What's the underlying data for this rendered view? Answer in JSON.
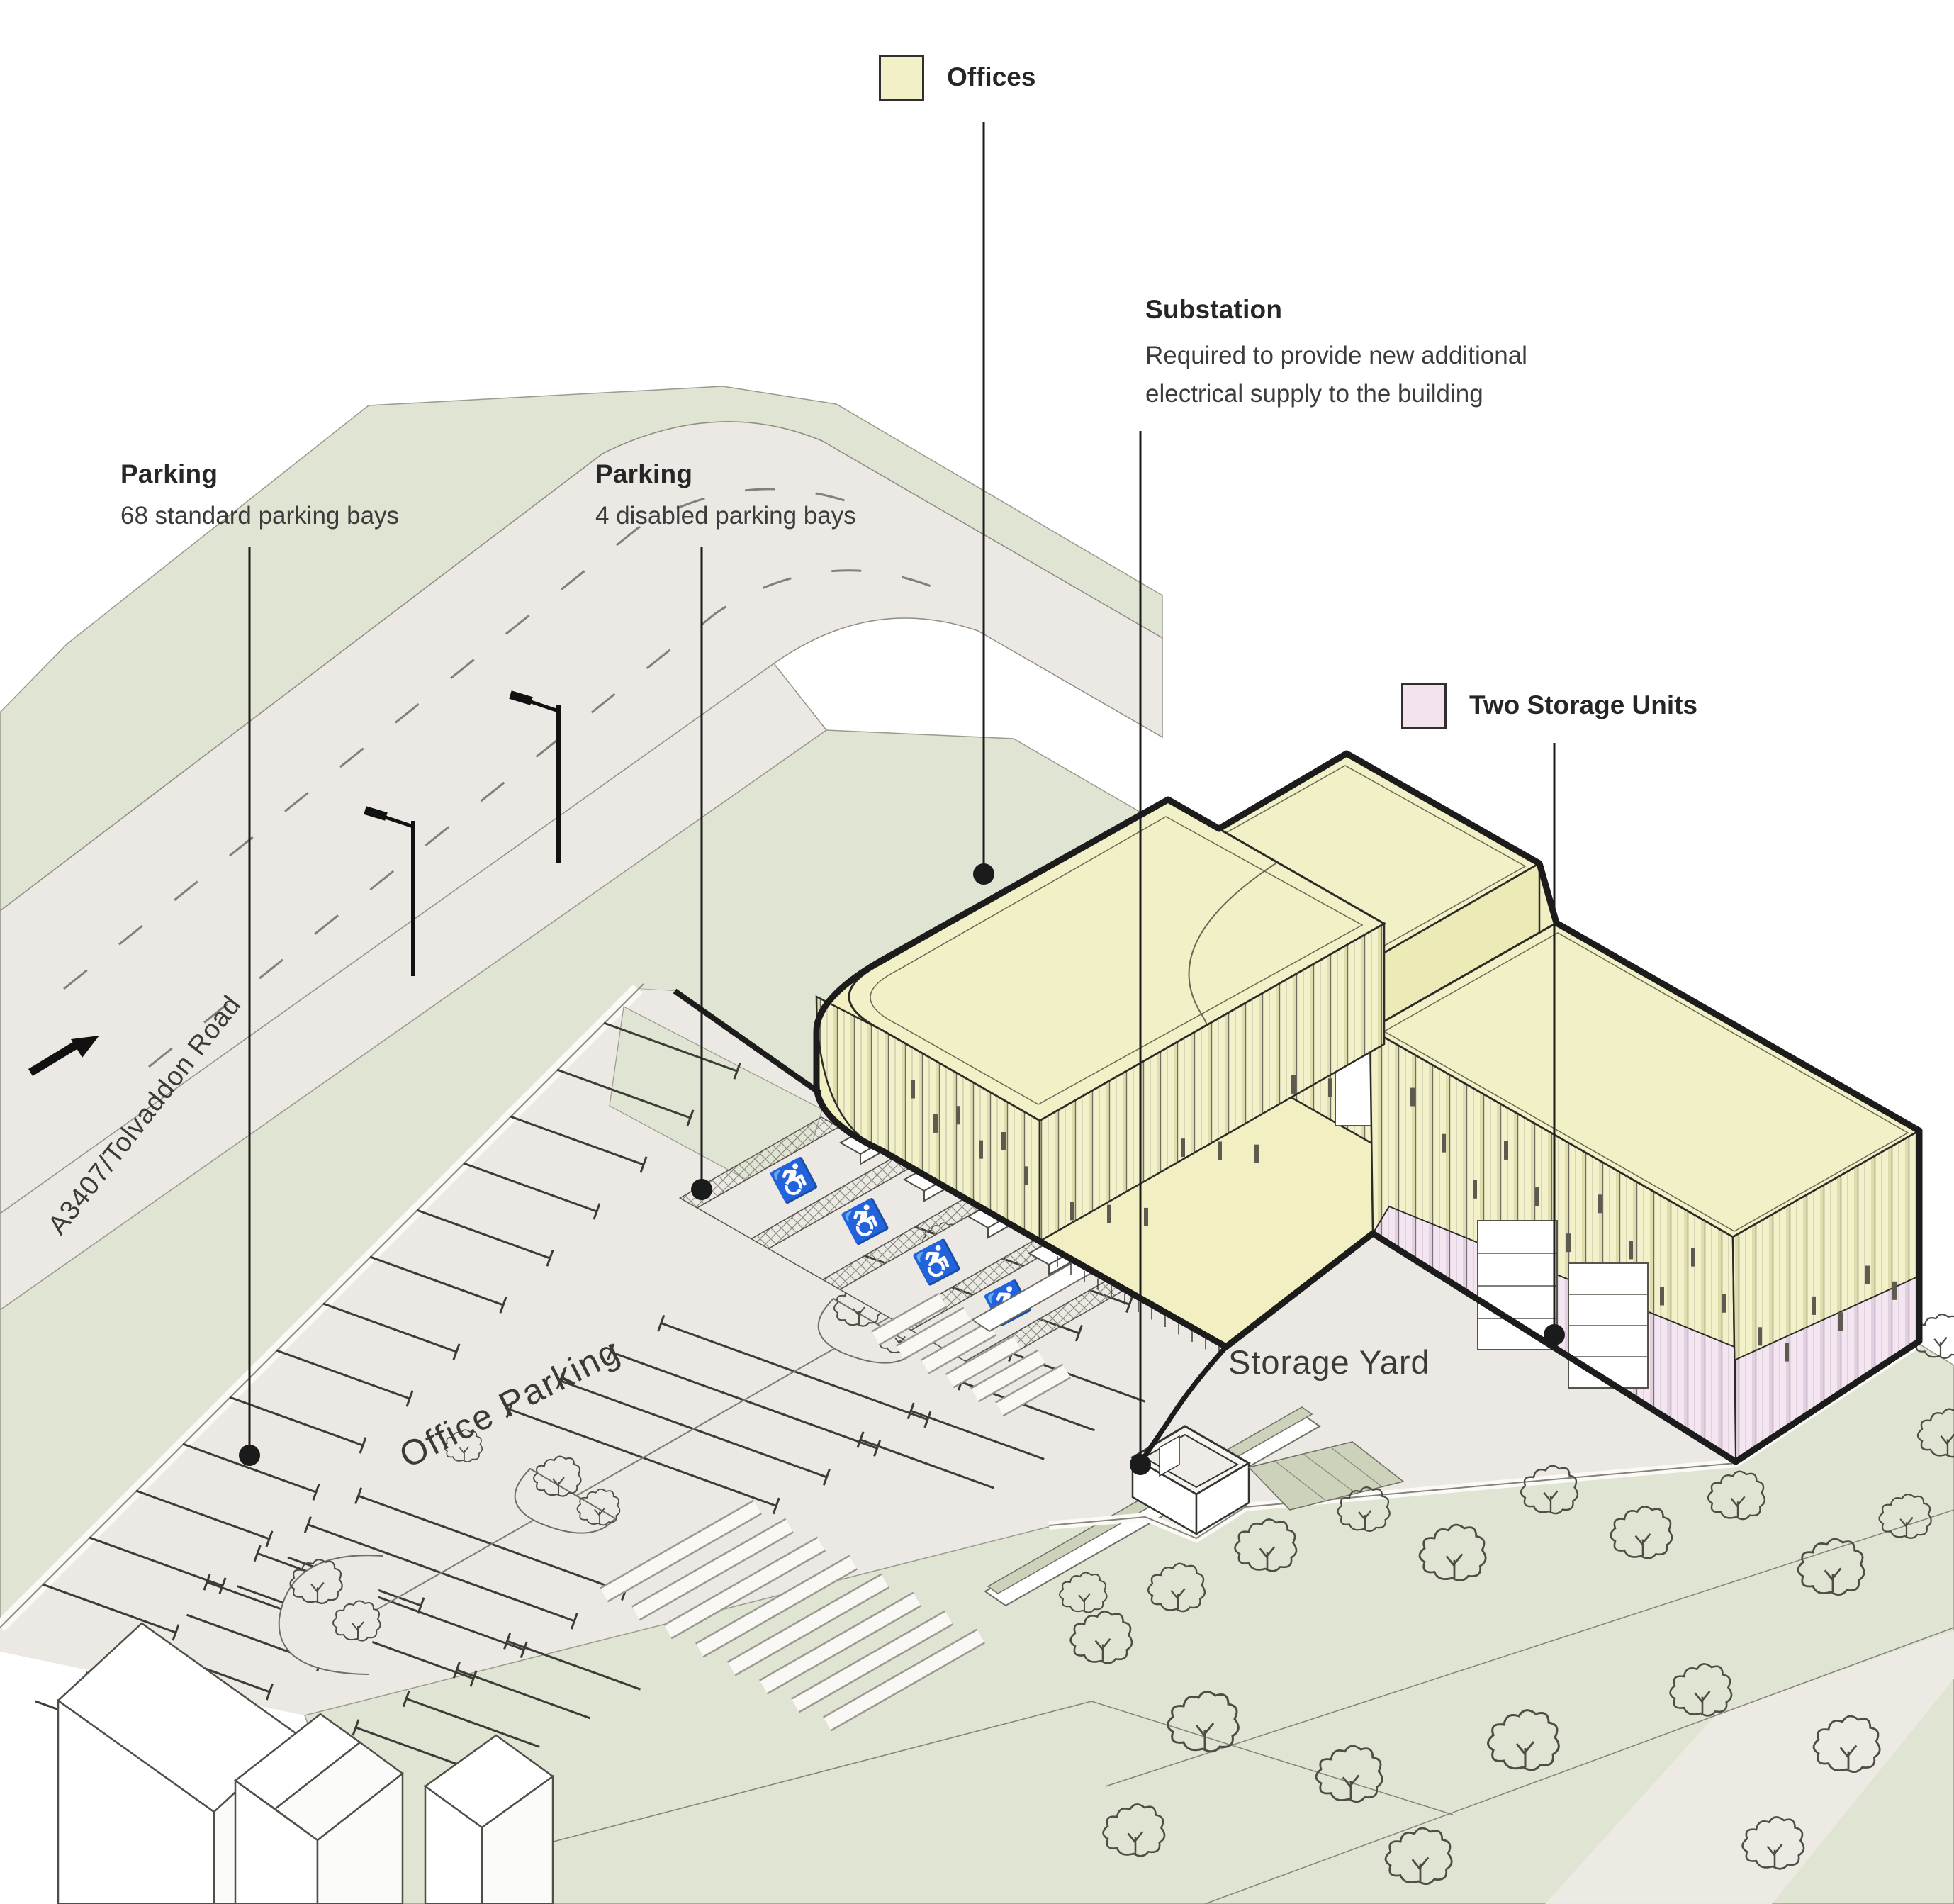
{
  "legend": {
    "offices": {
      "label": "Offices",
      "color": "#f2f0c6"
    },
    "two_storage_units": {
      "label": "Two Storage Units",
      "color": "#f2e3ee"
    }
  },
  "annotations": {
    "parking_standard": {
      "title": "Parking",
      "description": "68 standard parking bays"
    },
    "parking_disabled": {
      "title": "Parking",
      "description": "4 disabled parking bays"
    },
    "substation": {
      "title": "Substation",
      "description_1": "Required to provide new additional",
      "description_2": "electrical supply to the building"
    }
  },
  "site_labels": {
    "office_parking": "Office Parking",
    "storage_yard": "Storage Yard",
    "road": "A3407/Tolvaddon Road"
  },
  "icons": {
    "wheelchair": "♿"
  },
  "colors": {
    "offices_fill": "#f2f0c6",
    "storage_fill": "#f2e3ee",
    "greenspace": "#e0e4d2",
    "greenspace_dark": "#cdd3ba",
    "hardstanding": "#ece8e4",
    "outline": "#1c1c1c"
  }
}
